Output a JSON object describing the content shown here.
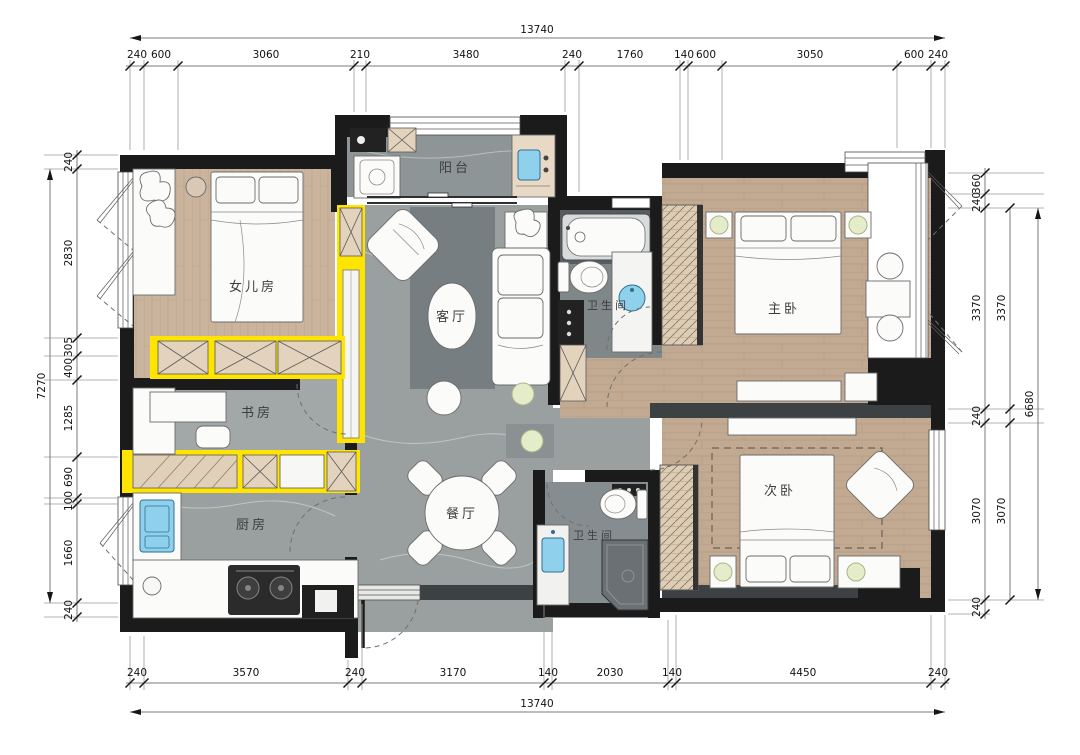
{
  "plan": {
    "rooms": [
      {
        "id": "daughter-room",
        "label": "女儿房"
      },
      {
        "id": "study",
        "label": "书房"
      },
      {
        "id": "kitchen",
        "label": "厨房"
      },
      {
        "id": "balcony",
        "label": "阳台"
      },
      {
        "id": "living-room",
        "label": "客厅"
      },
      {
        "id": "dining-room",
        "label": "餐厅"
      },
      {
        "id": "bathroom-1",
        "label": "卫生间"
      },
      {
        "id": "master-bedroom",
        "label": "主卧"
      },
      {
        "id": "bathroom-2",
        "label": "卫生间"
      },
      {
        "id": "second-bedroom",
        "label": "次卧"
      }
    ],
    "colors": {
      "wall": "#1b1b1b",
      "accent_yellow": "#ffe400",
      "wood_floor": "#c2a992",
      "grey_tile": "#9aa09f",
      "fixture_blue": "#8fd0ec",
      "plant_green": "#e4ecca"
    }
  },
  "dims": {
    "top": {
      "overall": "13740",
      "segments": [
        "240",
        "600",
        "3060",
        "210",
        "3480",
        "240",
        "1760",
        "140",
        "600",
        "3050",
        "600",
        "240"
      ]
    },
    "bottom": {
      "overall": "13740",
      "segments": [
        "240",
        "3570",
        "240",
        "3170",
        "140",
        "2030",
        "140",
        "4450",
        "240"
      ]
    },
    "left": {
      "overall": "7270",
      "segments": [
        "240",
        "2830",
        "305",
        "400",
        "1285",
        "690",
        "100",
        "1660",
        "240"
      ]
    },
    "right": {
      "overall": "6680",
      "inner": [
        "360",
        "240",
        "3370",
        "240",
        "3070",
        "240"
      ],
      "mid": [
        "3370",
        "3070"
      ]
    }
  }
}
